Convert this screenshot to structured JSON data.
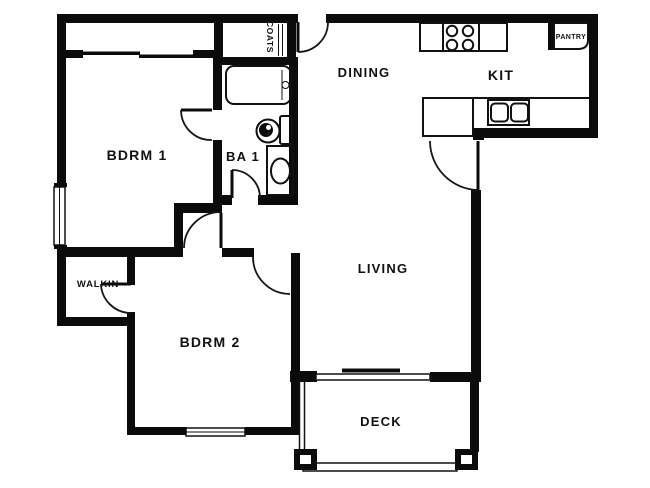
{
  "document": {
    "type": "apartment floor plan",
    "background": "#ffffff"
  },
  "colors": {
    "wall": "#0b0b0b",
    "line": "#111111",
    "label": "#111111"
  },
  "rooms": {
    "bdrm1": {
      "label": "BDRM 1"
    },
    "ba1": {
      "label": "BA 1"
    },
    "coats": {
      "label": "COATS"
    },
    "dining": {
      "label": "DINING"
    },
    "kit": {
      "label": "KIT"
    },
    "pantry": {
      "label": "PANTRY"
    },
    "walkin": {
      "label": "WALKIN"
    },
    "bdrm2": {
      "label": "BDRM 2"
    },
    "living": {
      "label": "LIVING"
    },
    "deck": {
      "label": "DECK"
    }
  },
  "fixtures": {
    "bathtub": "bathtub",
    "toilet": "toilet",
    "vanity_sink": "vanity-sink",
    "range": "4-burner-range",
    "kitchen_sink": "double-basin-sink",
    "sliding_glass_door": "sliding-glass-door",
    "windows": [
      "bdrm1-left-window",
      "bdrm2-bottom-window"
    ],
    "closet_doors": "bypass-sliding-doors",
    "deck_posts": 2,
    "door_swings": 7
  }
}
